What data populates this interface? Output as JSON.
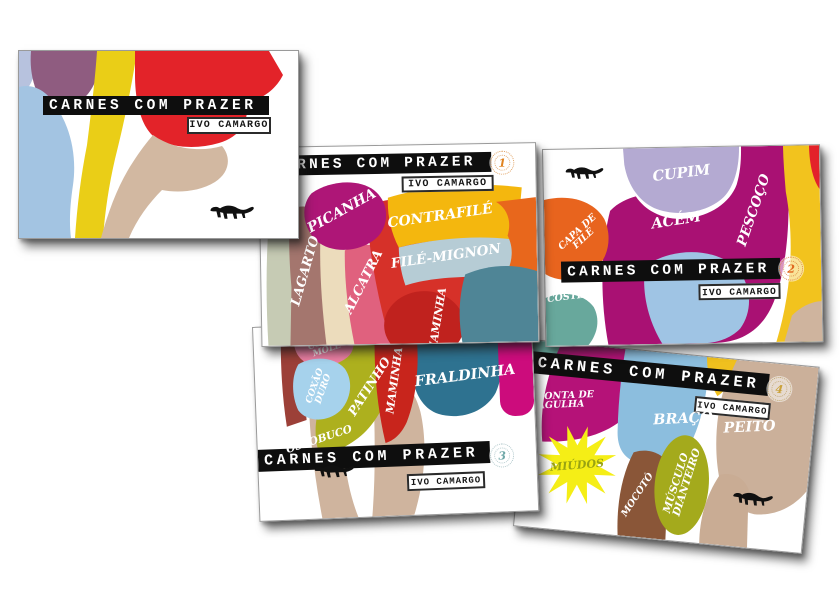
{
  "artwork": {
    "title": "CARNES COM PRAZER",
    "author": "IVO CAMARGO",
    "animal_icon": "ferret-silhouette",
    "card_count": 5
  },
  "palette": {
    "title_bar_black": "#0e0e0e",
    "picanha_magenta": "#ae1677",
    "contrafile_yellow": "#f4b70e",
    "file_mignon_blue": "#b6ccd5",
    "alcatra_rose": "#e0617e",
    "lagarto_mauve": "#a4766e",
    "cupim_lavender": "#b4aad2",
    "acem_magenta": "#a91173",
    "pescoco_yellow": "#f2c31e",
    "capa_de_file_orange": "#e8641e",
    "costela_teal": "#68a89c",
    "coxao_mole_pink": "#ec7fa4",
    "coxao_duro_blue": "#a6d2ec",
    "patinho_olive": "#adb01e",
    "maminha_red": "#c8251c",
    "fraldinha_steel": "#2e7290",
    "ponta_de_agulha_magenta": "#b51278",
    "miudos_yellow": "#f5ee16",
    "braco_blue": "#8cbede",
    "peito_tan": "#cbb09a",
    "mocoto_brown": "#8a5638",
    "musculo_dianteiro_olive": "#a4aa1c",
    "cover_red": "#e32329",
    "cover_yellow": "#eace17",
    "cover_blue": "#a3c4e2",
    "cover_plum": "#8f5c80",
    "cover_tan": "#d2b8a1"
  },
  "cards": {
    "card1": {
      "stamp_number": "1",
      "labels": {
        "picanha": "PICANHA",
        "contrafile": "CONTRAFILÉ",
        "file_mignon": "FILÉ-MIGNON",
        "alcatra": "ALCATRA",
        "lagarto": "LAGARTO",
        "maminha": "MAMINHA"
      }
    },
    "card2": {
      "stamp_number": "2",
      "labels": {
        "cupim": "CUPIM",
        "acem": "ACÉM",
        "pescoco": "PESCOÇO",
        "capa_de_file": "CAPA DE FILÉ",
        "costela": "COSTELA"
      }
    },
    "card3": {
      "stamp_number": "3",
      "labels": {
        "coxao_mole": "COXÃO MOLE",
        "coxao_duro": "COXÃO DURO",
        "patinho": "PATINHO",
        "maminha": "MAMINHA",
        "fraldinha": "FRALDINHA",
        "ossobuco": "OSSOBUCO"
      }
    },
    "card4": {
      "stamp_number": "4",
      "labels": {
        "ponta_de_agulha": "PONTA DE AGULHA",
        "miudos": "MIÚDOS",
        "braco": "BRAÇO",
        "peito": "PEITO",
        "mocoto": "MOCOTÓ",
        "musculo_dianteiro": "MÚSCULO DIANTEIRO"
      }
    }
  }
}
